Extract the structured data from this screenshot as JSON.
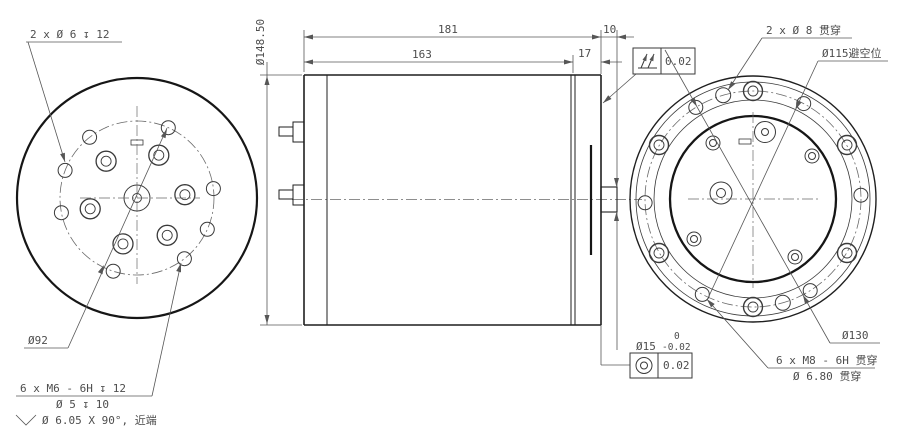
{
  "drawing": {
    "colors": {
      "background": "#ffffff",
      "geometry": "#1f1f1f",
      "dimension": "#565656"
    },
    "left_view": {
      "callout_top_holes": "2 x Ø 6 ↧ 12",
      "callout_bolt_circle": "Ø92",
      "callout_tapped_line1": "6 x M6 - 6H ↧ 12",
      "callout_tapped_line2": "Ø 5 ↧ 10",
      "callout_tapped_line3": "Ø 6.05 X 90°, 近端"
    },
    "front_view": {
      "dim_overall_length": "181",
      "dim_body_length": "163",
      "dim_cap_length": "17",
      "dim_shaft_length": "10",
      "dim_outer_diameter": "Ø148.50",
      "total_runout_value": "0.02",
      "shaft_diameter": "Ø15",
      "shaft_tol_upper": "0",
      "shaft_tol_lower": "-0.02",
      "concentricity_value": "0.02"
    },
    "right_view": {
      "callout_through_holes": "2 x Ø 8 贯穿",
      "callout_clearance": "Ø115避空位",
      "callout_bolt_circle": "Ø130",
      "callout_tapped_line1": "6 x M8 - 6H 贯穿",
      "callout_tapped_line2": "Ø 6.80 贯穿"
    }
  }
}
